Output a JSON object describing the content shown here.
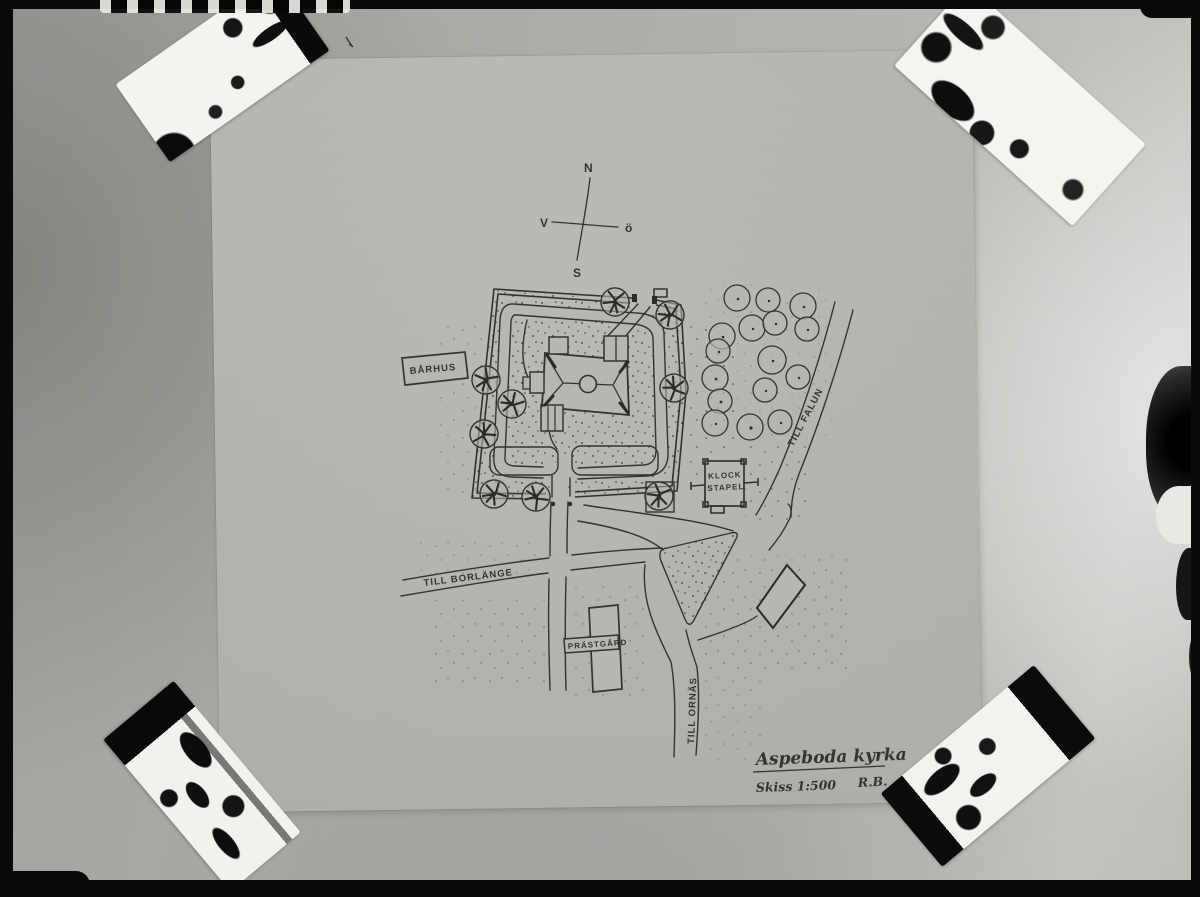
{
  "compass": {
    "north": "N",
    "west": "V",
    "east": "ö",
    "south": "S"
  },
  "labels": {
    "barhus": "BÅRHUS",
    "klockstapel1": "KLOCK",
    "klockstapel2": "STAPEL",
    "prastgard": "PRÄSTGÅRD"
  },
  "roads": {
    "borlange": "TILL BORLÄNGE",
    "falun": "TILL FALUN",
    "ornas": "TILL ORNÄS"
  },
  "caption": {
    "title": "Aspeboda kyrka",
    "scale": "Skiss 1:500",
    "initials": "R.B."
  },
  "colors": {
    "ink": "#34332f",
    "paper": "#b7b6b1",
    "photo_grey": "#acaba8",
    "frame_black": "#0a0a0a",
    "tape_white": "#f4f3f0"
  }
}
